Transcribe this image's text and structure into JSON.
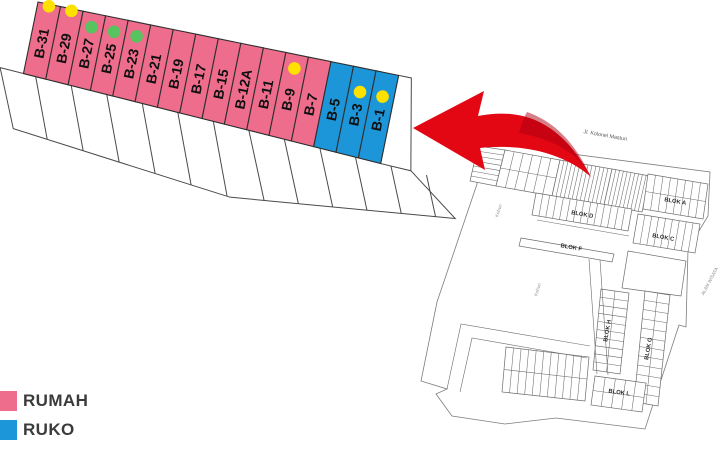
{
  "legend": {
    "items": [
      {
        "label": "RUMAH",
        "color": "#EF6D8C"
      },
      {
        "label": "RUKO",
        "color": "#1D96D9"
      }
    ]
  },
  "block_b": {
    "colors": {
      "rumah": "#EF6D8C",
      "ruko": "#1D96D9",
      "yellow": "#FFE100",
      "green": "#57C45F"
    },
    "lots": [
      {
        "label": "B-31",
        "type": "rumah",
        "dot": "yellow",
        "dot_pos": "top"
      },
      {
        "label": "B-29",
        "type": "rumah",
        "dot": "yellow",
        "dot_pos": "top"
      },
      {
        "label": "B-27",
        "type": "rumah",
        "dot": "green",
        "dot_pos": "upper"
      },
      {
        "label": "B-25",
        "type": "rumah",
        "dot": "green",
        "dot_pos": "upper"
      },
      {
        "label": "B-23",
        "type": "rumah",
        "dot": "green",
        "dot_pos": "upper"
      },
      {
        "label": "B-21",
        "type": "rumah",
        "dot": null,
        "dot_pos": null
      },
      {
        "label": "B-19",
        "type": "rumah",
        "dot": null,
        "dot_pos": null
      },
      {
        "label": "B-17",
        "type": "rumah",
        "dot": null,
        "dot_pos": null
      },
      {
        "label": "B-15",
        "type": "rumah",
        "dot": null,
        "dot_pos": null
      },
      {
        "label": "B-12A",
        "type": "rumah",
        "dot": null,
        "dot_pos": null
      },
      {
        "label": "B-11",
        "type": "rumah",
        "dot": null,
        "dot_pos": null
      },
      {
        "label": "B-9",
        "type": "rumah",
        "dot": "yellow",
        "dot_pos": "upper"
      },
      {
        "label": "B-7",
        "type": "rumah",
        "dot": null,
        "dot_pos": null
      },
      {
        "label": "B-5",
        "type": "ruko",
        "dot": null,
        "dot_pos": null
      },
      {
        "label": "B-3",
        "type": "ruko",
        "dot": "yellow",
        "dot_pos": "mid"
      },
      {
        "label": "B-1",
        "type": "ruko",
        "dot": "yellow",
        "dot_pos": "mid"
      }
    ]
  },
  "arrow": {
    "color": "#E30613",
    "shade_color": "#AD0010"
  },
  "map": {
    "street_label": "Jl. Kolonel Masturi",
    "area_label_right": "ALAM WISATA",
    "field_labels": [
      "Kebun",
      "Kebun"
    ],
    "blok_labels": {
      "a": "BLOK A",
      "c": "BLOK C",
      "d": "BLOK D",
      "f": "BLOK F",
      "g": "BLOK G",
      "h": "BLOK H",
      "l": "BLOK L"
    }
  }
}
